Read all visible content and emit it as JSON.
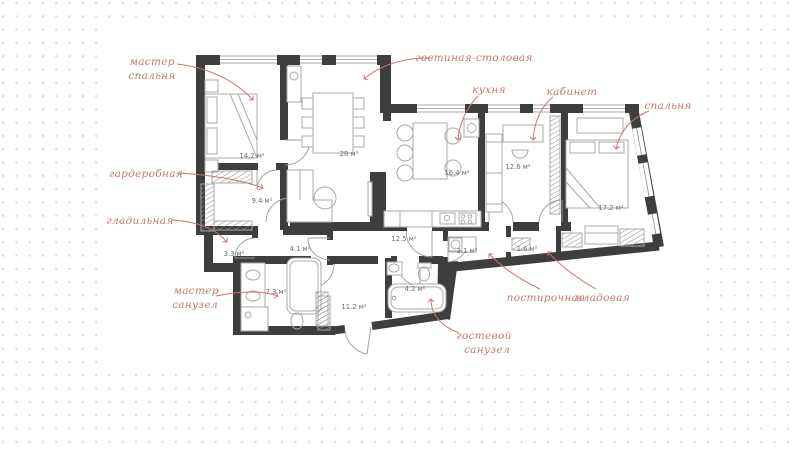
{
  "background": {
    "dot_color": "#d6d6d6",
    "canvas_color": "#ffffff"
  },
  "plan": {
    "wall_color": "#3e3e3e",
    "annotation_color": "#c4796b",
    "area_text_color": "#6e6e6e",
    "furniture_color": "#a8a8a8",
    "rooms": {
      "master_bedroom": {
        "label_line1": "мастер",
        "label_line2": "спальня",
        "area": "14.2 м²"
      },
      "wardrobe": {
        "label": "гардеробная",
        "area": "9.4 м²"
      },
      "ironing_room": {
        "label": "гладильная",
        "area": "3.3 м²"
      },
      "master_bathroom": {
        "label_line1": "мастер",
        "label_line2": "санузел",
        "area": "7.3 м²"
      },
      "living_dining": {
        "label": "гостиная-столовая",
        "area": "28 м²"
      },
      "kitchen": {
        "label": "кухня",
        "area": "16.4 м²"
      },
      "office": {
        "label": "кабинет",
        "area": "12.6 м²"
      },
      "bedroom": {
        "label": "спальня",
        "area": "17.2 м²"
      },
      "hallway": {
        "area": "12.5 м²"
      },
      "inner_hall": {
        "area": "4.1 м²"
      },
      "entry_hall": {
        "area": "11.2 м²"
      },
      "guest_bathroom": {
        "label_line1": "гостевой",
        "label_line2": "санузел",
        "area": "4.2 м²"
      },
      "laundry": {
        "label": "постирочная",
        "area": "3.1 м²"
      },
      "storage": {
        "label": "кладовая",
        "area": "1.6 м²"
      }
    }
  }
}
